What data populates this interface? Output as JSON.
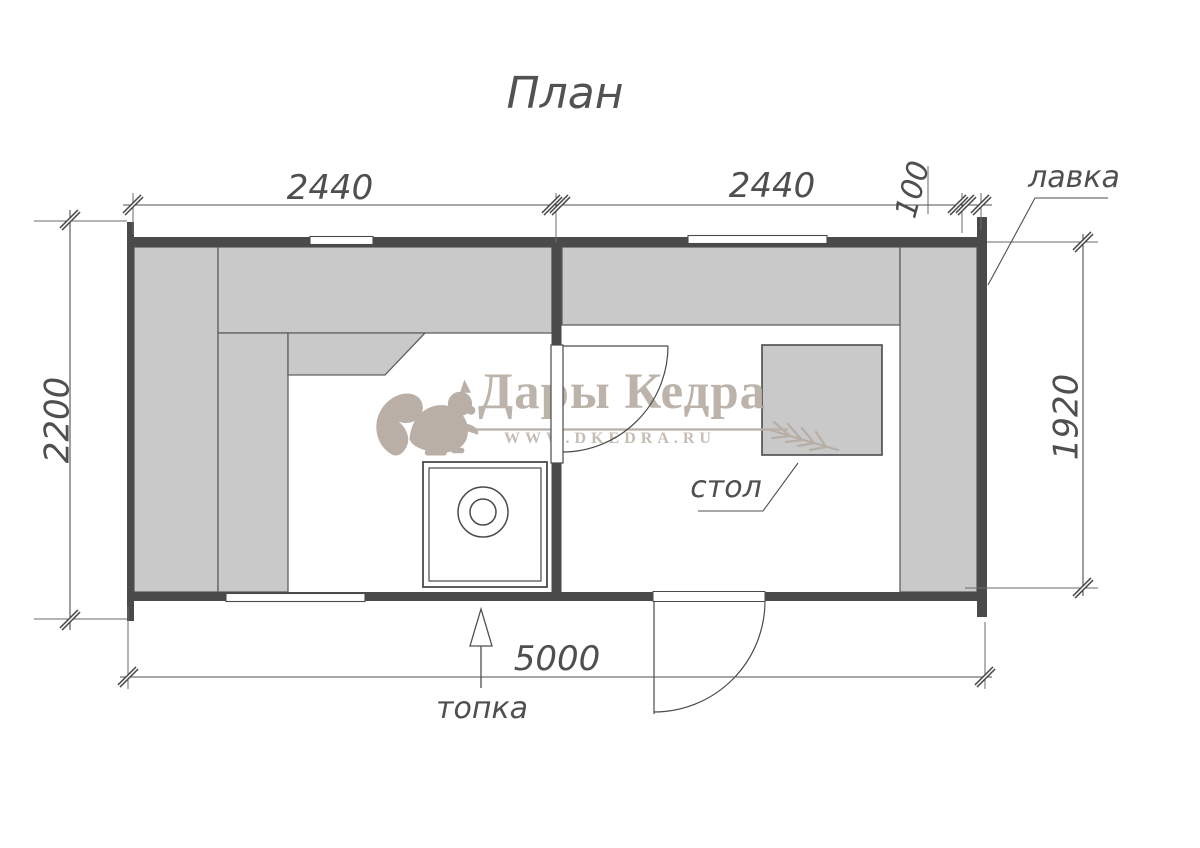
{
  "title": "План",
  "plan": {
    "labels": {
      "bench": "лавка",
      "table": "стол",
      "firebox": "топка"
    },
    "dimensions": {
      "room_left_width": "2440",
      "room_right_width": "2440",
      "wall_offset": "100",
      "height_overall": "2200",
      "room_right_height": "1920",
      "length_overall": "5000"
    }
  },
  "watermark": {
    "brand": "Дары Кедра",
    "url": "WWW.DKEDRA.RU",
    "logo_icon": "squirrel-icon",
    "decor_icon": "cedar-branch-icon"
  },
  "colors": {
    "wall": "#4a4a4a",
    "bench_fill": "#c9c9c9",
    "line": "#4f4f4f",
    "watermark": "#b7aea6",
    "background": "#ffffff"
  }
}
